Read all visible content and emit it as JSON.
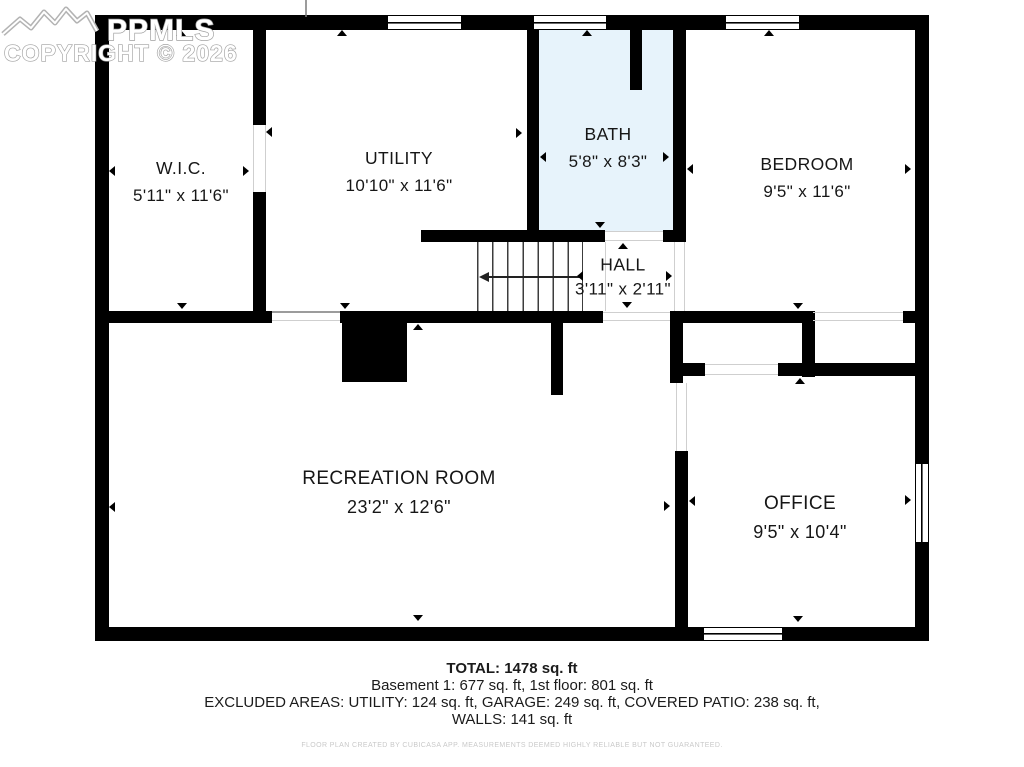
{
  "watermark": {
    "brand": "PPMLS",
    "copyright": "COPYRIGHT © 2026"
  },
  "rooms": [
    {
      "name": "W.I.C.",
      "dims": "5'11\" x 11'6\""
    },
    {
      "name": "UTILITY",
      "dims": "10'10\" x 11'6\""
    },
    {
      "name": "BATH",
      "dims": "5'8\" x 8'3\""
    },
    {
      "name": "BEDROOM",
      "dims": "9'5\" x 11'6\""
    },
    {
      "name": "HALL",
      "dims": "3'11\" x 2'11\""
    },
    {
      "name": "RECREATION ROOM",
      "dims": "23'2\" x 12'6\""
    },
    {
      "name": "OFFICE",
      "dims": "9'5\" x 10'4\""
    }
  ],
  "summary": {
    "total": "TOTAL: 1478 sq. ft",
    "floors": "Basement 1: 677 sq. ft, 1st floor: 801 sq. ft",
    "excluded": "EXCLUDED AREAS: UTILITY: 124 sq. ft, GARAGE: 249 sq. ft, COVERED PATIO: 238 sq. ft,",
    "walls": "WALLS: 141 sq. ft",
    "disclaimer": "FLOOR PLAN CREATED BY CUBICASA APP. MEASUREMENTS DEEMED HIGHLY RELIABLE BUT NOT GUARANTEED."
  },
  "colors": {
    "wall": "#000000",
    "bath_fill": "#e7f3fb",
    "text": "#1b1b1b",
    "watermark_gray": "#a8a8a8",
    "disclaimer_gray": "#c9c9c9"
  }
}
